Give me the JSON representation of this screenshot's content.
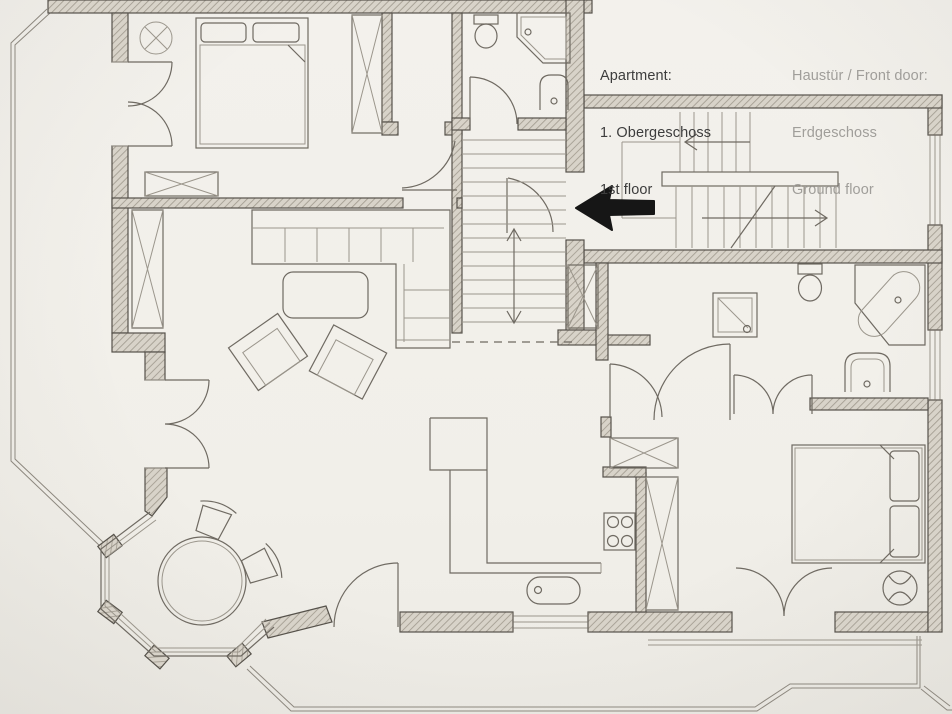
{
  "page": {
    "width": 952,
    "height": 714,
    "kind": "hand-drawn architectural floor plan"
  },
  "annotations": {
    "apartment": {
      "title": "Apartment:",
      "line_de": "1. Obergeschoss",
      "line_en": "1st floor"
    },
    "front_door": {
      "title": "Haustür / Front door:",
      "line_de": "Erdgeschoss",
      "line_en": "Ground floor"
    }
  },
  "colors": {
    "text_dark": "#3d3d3d",
    "text_gray": "#a09e9a",
    "wall_line": "#56524b",
    "pencil": "#6f6a62",
    "arrow_black": "#161616",
    "paper": "#f2f0eb"
  }
}
